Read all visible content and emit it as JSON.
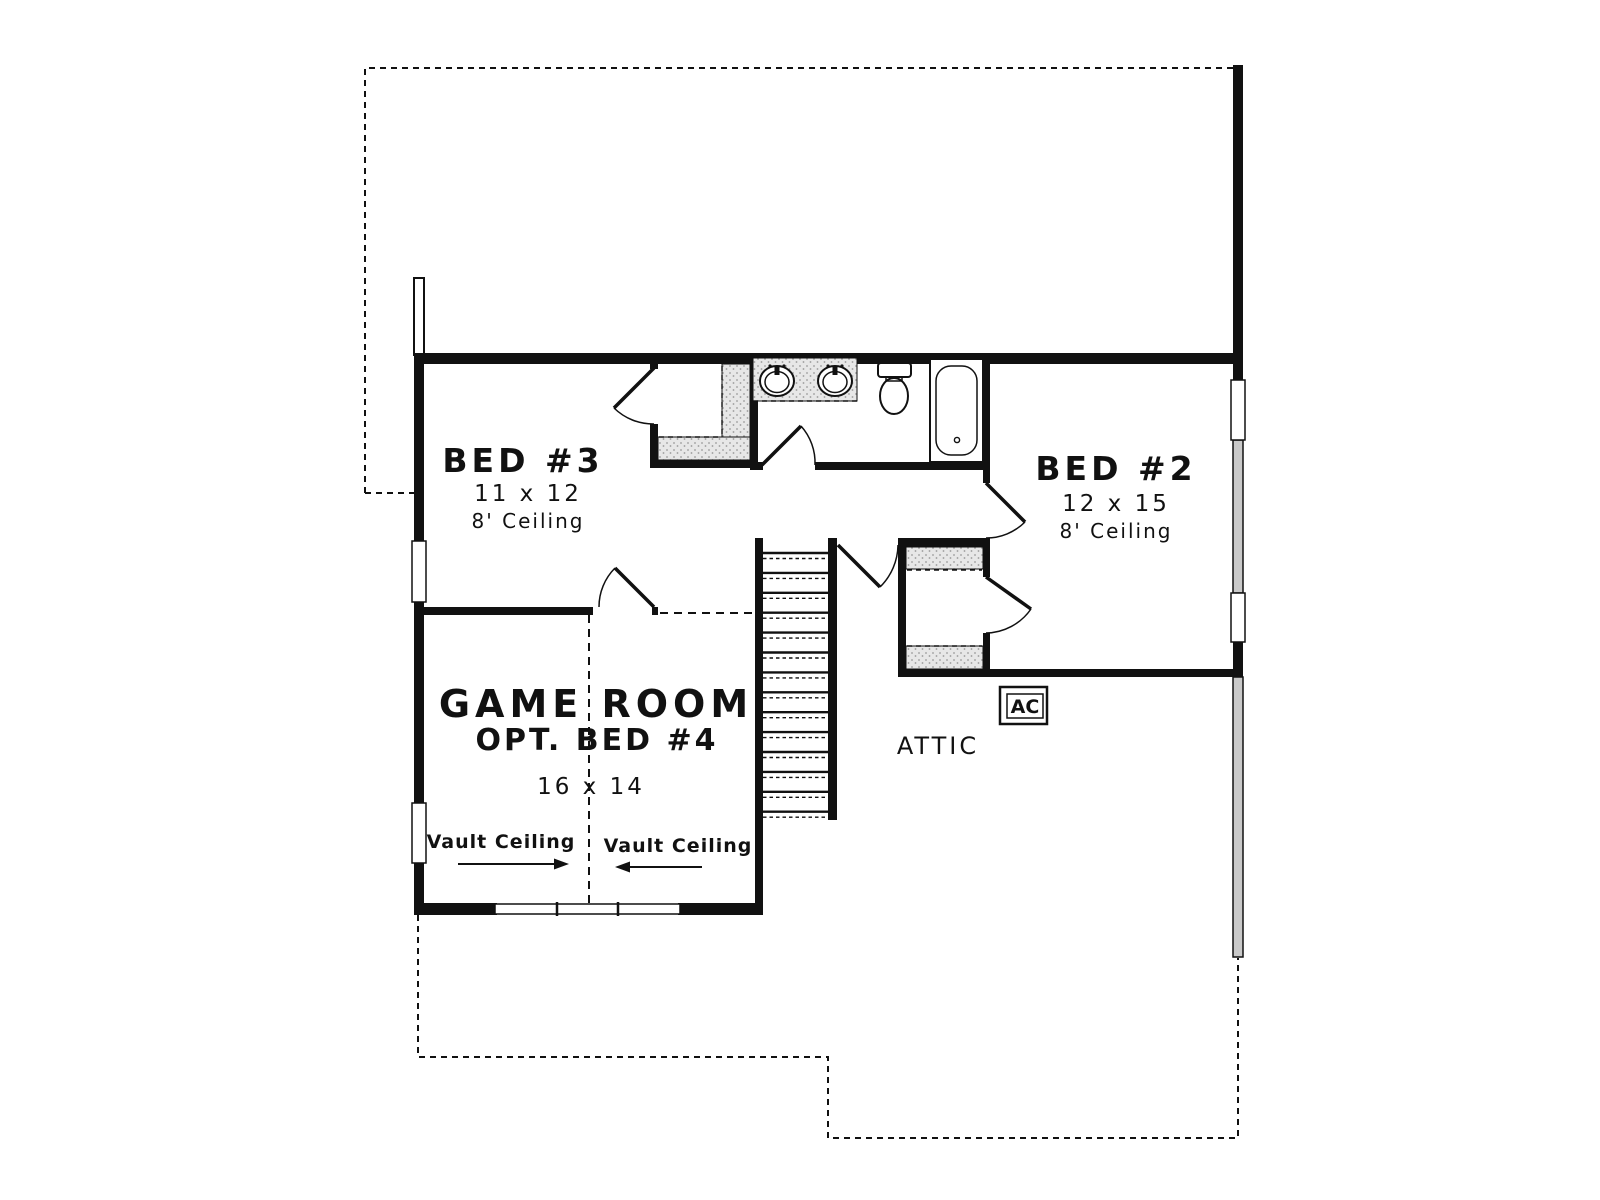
{
  "rooms": {
    "bed3": {
      "name": "BED #3",
      "size": "11 x 12",
      "ceiling": "8' Ceiling"
    },
    "bed2": {
      "name": "BED #2",
      "size": "12 x 15",
      "ceiling": "8' Ceiling"
    },
    "game_room": {
      "name": "GAME ROOM",
      "option": "OPT. BED #4",
      "size": "16 x 14"
    },
    "attic": {
      "name": "ATTIC"
    }
  },
  "annotations": {
    "vault_ceiling_left": "Vault Ceiling",
    "vault_ceiling_right": "Vault Ceiling",
    "ac_unit": "AC"
  },
  "colors": {
    "line": "#111111",
    "background": "#ffffff",
    "hatch_fill": "#e7e7e7",
    "wall_core_gray": "#c9c9c9"
  }
}
